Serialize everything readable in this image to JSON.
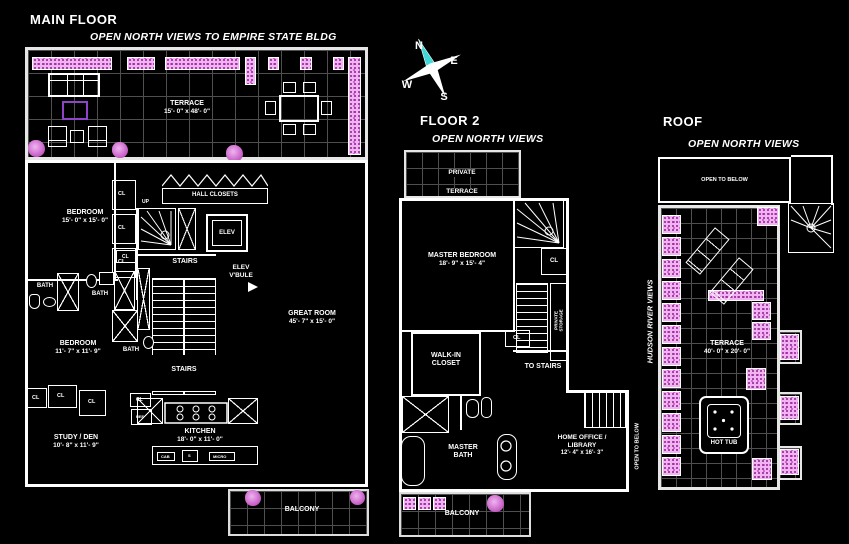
{
  "compass": {
    "north": "N",
    "east": "E",
    "south": "S",
    "west": "W"
  },
  "main_floor": {
    "title": "MAIN FLOOR",
    "view_note": "OPEN NORTH VIEWS TO EMPIRE STATE BLDG",
    "terrace_name": "TERRACE",
    "terrace_dims": "15'- 0\" x 48'- 0\"",
    "bedroom1_name": "BEDROOM",
    "bedroom1_dims": "15'- 0\" x 15'- 0\"",
    "up": "UP",
    "cl": "CL",
    "hall_closets": "HALL CLOSETS",
    "elev": "ELEV",
    "stairs": "STAIRS",
    "elev_vbule_line1": "ELEV",
    "elev_vbule_line2": "V'BULE",
    "bath": "BATH",
    "great_room_name": "GREAT ROOM",
    "great_room_dims": "45'- 7\" x 15'- 0\"",
    "bedroom2_name": "BEDROOM",
    "bedroom2_dims": "11'- 7\" x 11'- 9\"",
    "study_name": "STUDY / DEN",
    "study_dims": "10'- 8\" x 11'- 9\"",
    "kitchen_name": "KITCHEN",
    "kitchen_dims": "18'- 0\" x 11'- 0\"",
    "ref": "REF",
    "cab": "CAB",
    "sink": "S",
    "micro": "MICRO",
    "balcony": "BALCONY"
  },
  "floor2": {
    "title": "FLOOR 2",
    "view_note": "OPEN NORTH VIEWS",
    "private_terrace_line1": "PRIVATE",
    "private_terrace_line2": "TERRACE",
    "master_bedroom_name": "MASTER BEDROOM",
    "master_bedroom_dims": "18'- 9\" x 15'- 4\"",
    "cl": "CL",
    "private_storage_line1": "PRIVATE",
    "private_storage_line2": "STORAGE",
    "to_stairs": "TO STAIRS",
    "walkin_line1": "WALK-IN",
    "walkin_line2": "CLOSET",
    "master_bath_line1": "MASTER",
    "master_bath_line2": "BATH",
    "home_office_line1": "HOME OFFICE /",
    "home_office_line2": "LIBRARY",
    "home_office_dims": "12'- 4\" x 16'- 3\"",
    "open_to_below": "OPEN TO BELOW",
    "balcony": "BALCONY"
  },
  "roof": {
    "title": "ROOF",
    "view_note": "OPEN NORTH VIEWS",
    "open_to_below": "OPEN TO BELOW",
    "hudson": "HUDSON RIVER VIEWS",
    "terrace_name": "TERRACE",
    "terrace_dims": "40'- 0\" x 20'- 0\"",
    "hot_tub": "HOT TUB"
  }
}
